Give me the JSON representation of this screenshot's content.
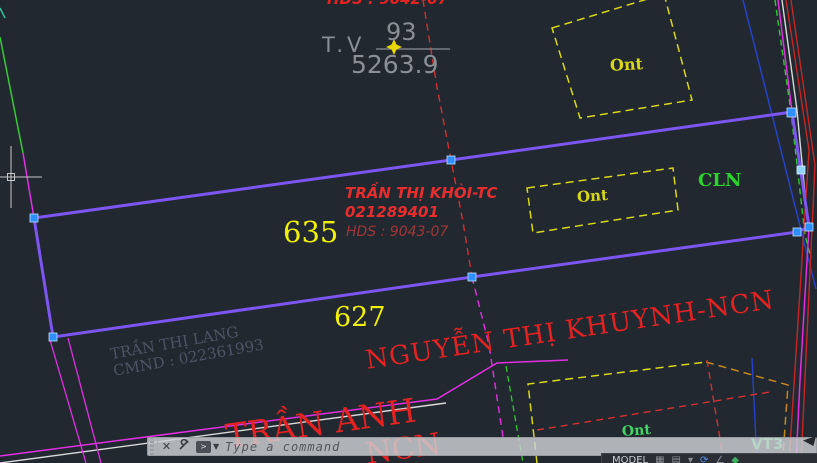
{
  "window": {
    "background": "#212830"
  },
  "annotations": {
    "top_parcel": {
      "hds": "HDS : 9042-07",
      "station": "T.V",
      "area_numerator": "93",
      "area_denominator": "5263.9"
    },
    "parcel_635": {
      "number": "635",
      "owner_name": "TRẦN THỊ KHÒI-TC",
      "owner_id": "021289401",
      "hds": "HDS : 9043-07"
    },
    "parcel_627": {
      "number": "627",
      "owner_name": "NGUYỄN THỊ KHUYNH-NCN"
    },
    "neighbor_left": {
      "name": "TRẦN THỊ LANG",
      "cmnd": "CMND : 022361993"
    },
    "neighbor_bottom": {
      "name": "TRẦN ANH",
      "fragment": "NCN"
    },
    "land_use": {
      "ont": "Ont",
      "cln": "CLN",
      "vt": "VT3"
    }
  },
  "colors": {
    "background": "#212830",
    "parcel_selected_line": "#7d55f0",
    "grip_blue": "#2e8fff",
    "grip_hover": "#8fd4ff",
    "magenta_line": "#e12fe1",
    "green_line": "#38c838",
    "red_line": "#c82525",
    "yellow_dashed": "#d8d818",
    "owner_red": "#e62e2e",
    "dark_red": "#a33636",
    "big_red": "#e32222",
    "yellow": "#f0f00a",
    "green": "#2ad42a",
    "green_soft": "#43d465",
    "vt_green": "#4fe085",
    "gray": "#8a8f96",
    "dim_gray": "#4d5464",
    "command_text": "#54575b",
    "model_text": "#c9ccd0"
  },
  "command_bar": {
    "placeholder": "Type a command",
    "close_icon": "✕"
  },
  "status_bar": {
    "model_label": "MODEL"
  }
}
